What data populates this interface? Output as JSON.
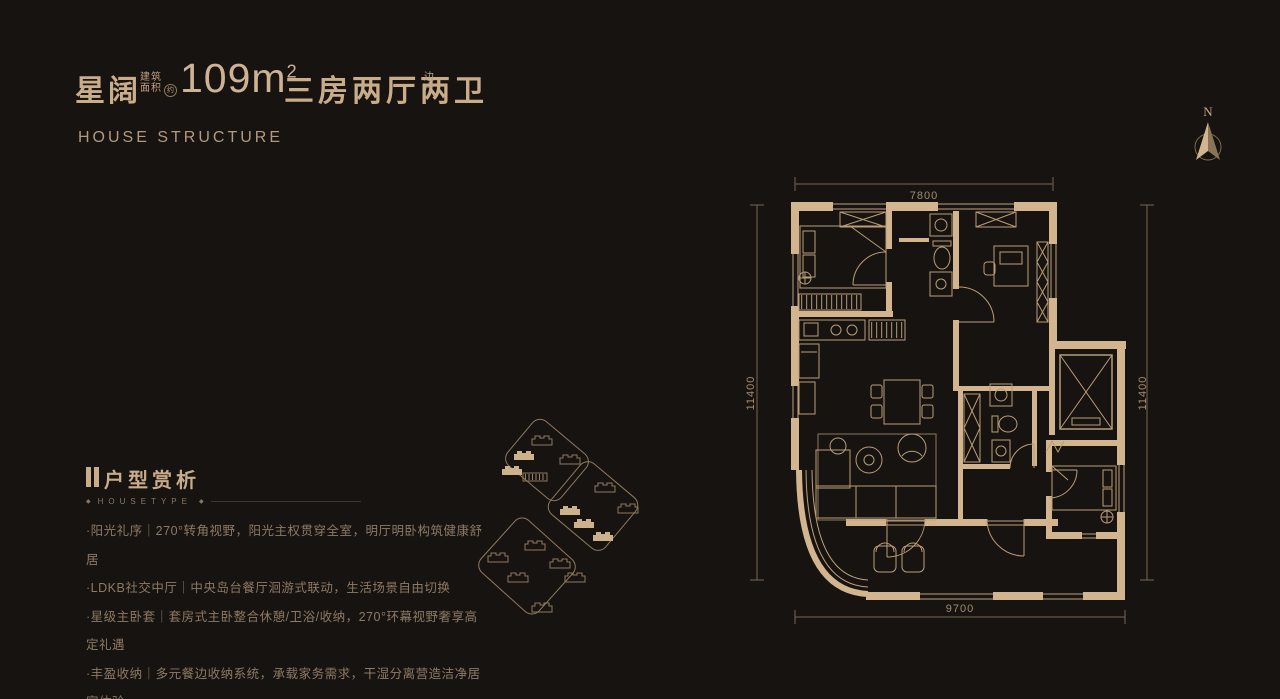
{
  "colors": {
    "background": "#171310",
    "gold": "#c9ac89",
    "wall_tan": "#d2b48f",
    "line_gold": "#b99c78",
    "dim_text": "#a58c6c",
    "body_dim": "#8d7a64"
  },
  "header": {
    "project_name": "星阔",
    "area_label": [
      "建筑",
      "面积"
    ],
    "area_approx": "约",
    "area_value": "109m",
    "area_exponent": "2",
    "layout_type": "三房两厅两卫",
    "unit_position": [
      "边",
      "户"
    ],
    "subtitle": "HOUSE STRUCTURE"
  },
  "compass": {
    "north_label": "N"
  },
  "floor_plan": {
    "dim_top": "7800",
    "dim_left": "11400",
    "dim_right": "11400",
    "dim_bottom": "9700"
  },
  "analysis": {
    "title": "户型赏析",
    "ornament": "◆",
    "tagline": "HOUSETYPE",
    "bullets": [
      "·阳光礼序｜270°转角视野，阳光主权贯穿全室，明厅明卧构筑健康舒居",
      "·LDKB社交中厅｜中央岛台餐厅洄游式联动，生活场景自由切换",
      "·星级主卧套｜套房式主卧整合休憩/卫浴/收纳，270°环幕视野奢享高定礼遇",
      "·丰盈收纳｜多元餐边收纳系统，承载家务需求，干湿分离营造洁净居家体验"
    ]
  }
}
